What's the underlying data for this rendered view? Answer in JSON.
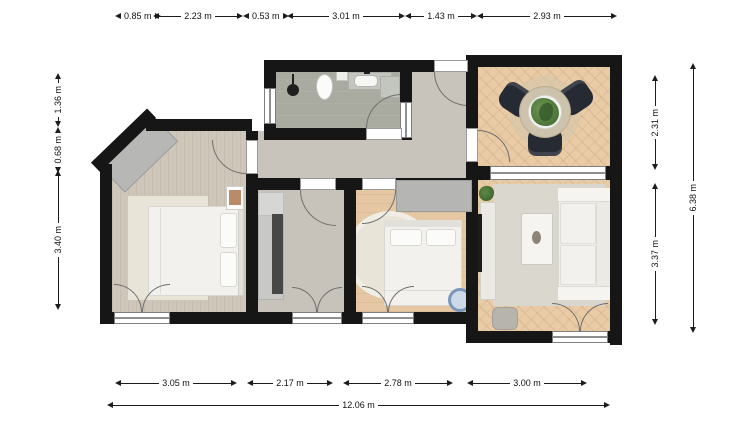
{
  "dimensions": {
    "top": [
      "0.85 m",
      "2.23 m",
      "0.53 m",
      "3.01 m",
      "1.43 m",
      "2.93 m"
    ],
    "left": [
      "1.36 m",
      "0.68 m",
      "3.40 m"
    ],
    "right": [
      "2.31 m",
      "3.37 m"
    ],
    "right_total": "6.38 m",
    "bottom": [
      "3.05 m",
      "2.17 m",
      "2.78 m",
      "3.00 m"
    ],
    "bottom_total": "12.06 m"
  },
  "colors": {
    "wall": "#161616",
    "bedroom_left_floor": "#cfc6ba",
    "hallway_floor": "#c8c4bc",
    "bathroom_floor": "#a9aba0",
    "office_floor": "#c7c3bb",
    "bedroom_middle_floor": "#e5c8a3",
    "parquet_floor": "#e9cba6",
    "rug_cream": "#e8e4d8",
    "rug_gray": "#dad7cf",
    "furniture_white": "#f0efeb",
    "wardrobe_gray": "#b5b5b3",
    "chair_dark": "#262a33",
    "bassinet_blue": "#7a97ba",
    "plant_green": "#4a7234"
  }
}
